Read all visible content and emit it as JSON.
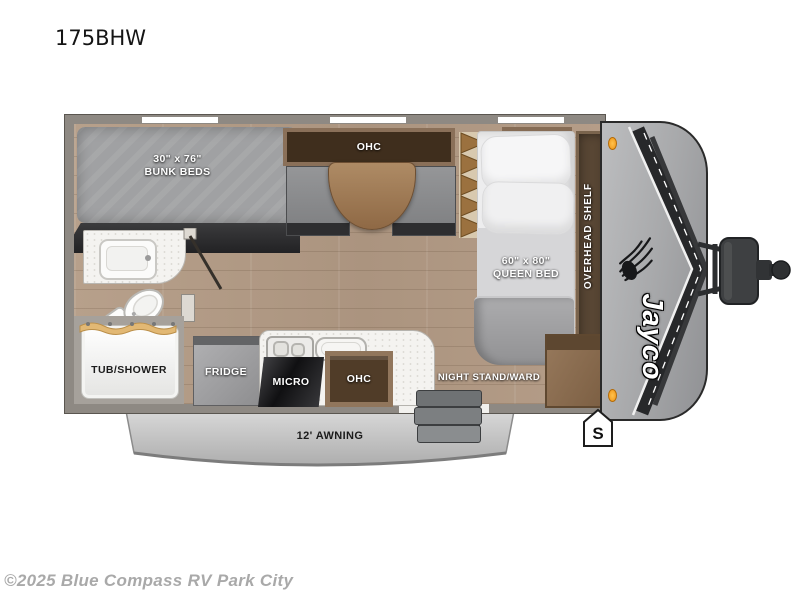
{
  "page": {
    "title": "175BHW",
    "copyright": "©2025 Blue Compass RV Park City"
  },
  "brand": {
    "name": "Jayco",
    "bird_icon": "eagle-silhouette",
    "marker_light_icon": "orange-clearance-light"
  },
  "labels": {
    "bunk_size": "30\" x 76\"",
    "bunk_name": "BUNK BEDS",
    "dinette_ohc": "OHC",
    "ac": "A/C",
    "queen_size": "60\" x 80\"",
    "queen_name": "QUEEN BED",
    "overhead_shelf": "OVERHEAD SHELF",
    "tub_shower": "TUB/SHOWER",
    "fridge": "FRIDGE",
    "micro": "MICRO",
    "kitchen_ohc": "OHC",
    "night_stand": "NIGHT STAND/WARD",
    "awning": "12' AWNING",
    "spare_marker": "S"
  },
  "colors": {
    "wall": "#8e8983",
    "floor_wood": "#b49e8a",
    "cabinet_wood": "#8a7059",
    "mattress_gray": "#a0a1a3",
    "front_cap_gray": "#a8a9ab",
    "awning_gray": "#c9c9c9",
    "marker_orange": "#f2a73d"
  }
}
